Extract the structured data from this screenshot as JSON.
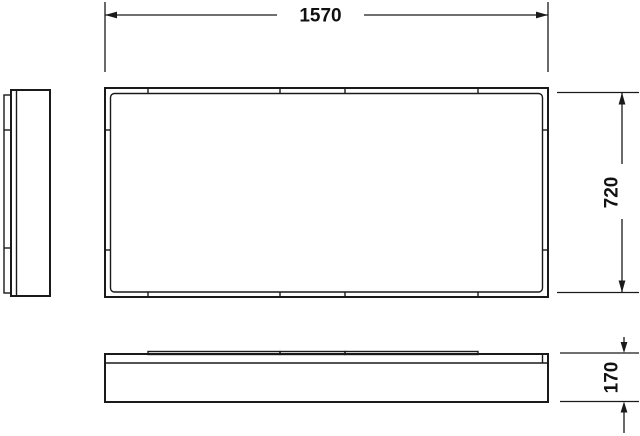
{
  "dims": {
    "width": "1570",
    "depth": "720",
    "height": "170"
  },
  "colors": {
    "line": "#1a1a1a",
    "panel_fill": "#f6f6f6",
    "background": "#ffffff"
  }
}
